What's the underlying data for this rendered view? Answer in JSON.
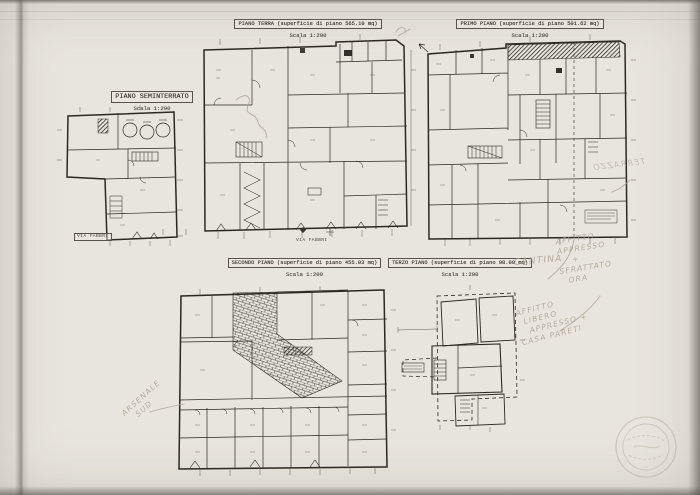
{
  "plans": {
    "seminterrato": {
      "title": "PIANO SEMINTERRATO",
      "scale": "Scala 1:200"
    },
    "terra": {
      "title": "PIANO TERRA (superficie di piano 565.10 mq)",
      "scale": "Scala 1:200",
      "street_label": "VIA FABBRI"
    },
    "primo": {
      "title": "PRIMO PIANO (superficie di piano 501.62 mq)",
      "scale": "Scala 1:200"
    },
    "secondo": {
      "title": "SECONDO PIANO (superficie di piano 455.03 mq)",
      "scale": "Scala 1:200"
    },
    "terzo": {
      "title": "TERZO PIANO (superficie di piano 98.09 mq)",
      "scale": "Scala 1:200"
    }
  },
  "street": {
    "seminterrato_label": "VIA FABBRI",
    "terra_label": "VIA FABBRI"
  },
  "annotations": {
    "cantina": "CANTINA",
    "terrazzo_mirrored": "TERRAZZO",
    "affitto_note_1": [
      "AFFITTO",
      "APPRESSO",
      "+",
      "SFRATTATO",
      "ORA"
    ],
    "affitto_note_2": [
      "AFFITTO",
      "LIBERO",
      "APPRESSO +",
      "CASA PARETI"
    ],
    "arsenale_note": [
      "ARSENALE",
      "SUD"
    ]
  },
  "colors": {
    "paper": "#e8e5de",
    "ink": "#2b2823",
    "pencil": "#a79d8d"
  }
}
